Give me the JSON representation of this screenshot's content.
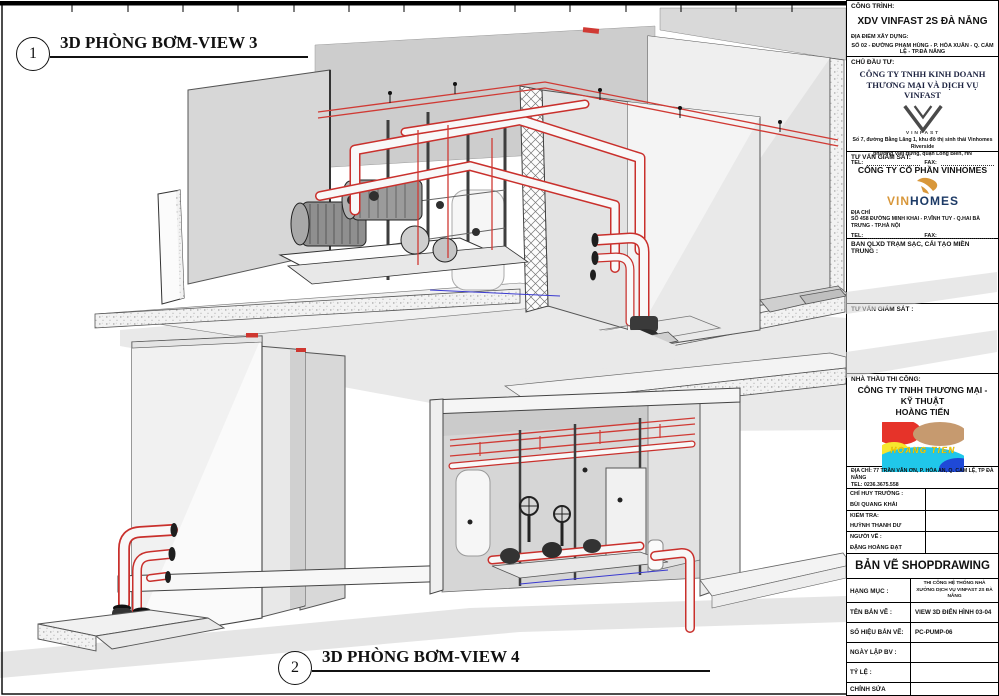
{
  "sheet": {
    "view3": {
      "number": "1",
      "title": "3D PHÒNG BƠM-VIEW 3"
    },
    "view4": {
      "number": "2",
      "title": "3D PHÒNG BƠM-VIEW 4"
    }
  },
  "title_block": {
    "project": {
      "label": "CÔNG TRÌNH:",
      "name": "XDV VINFAST 2S ĐÀ NẴNG",
      "site_label": "ĐỊA ĐIỂM XÂY DỰNG:",
      "site": "SỐ 02 - ĐƯỜNG PHẠM HÙNG - P. HÒA XUÂN - Q. CẨM LỆ - TP.ĐÀ NẴNG"
    },
    "investor": {
      "label": "CHỦ ĐẦU TƯ:",
      "company_line1": "CÔNG TY TNHH KINH DOANH",
      "company_line2": "THƯƠNG MẠI VÀ DỊCH VỤ  VINFAST",
      "logo_text": "VINFAST",
      "address_line1": "Số 7, đường Bằng Lăng 1, khu đô thị sinh thái Vinhomes Riverside",
      "address_line2": "phường Việt Hưng, quận Long Biên, HN",
      "tel_label": "TEL:",
      "fax_label": "FAX:"
    },
    "supervisor": {
      "label": "TƯ VẤN GIÁM SÁT:",
      "company": "CÔNG TY CỔ PHẦN VINHOMES",
      "logo_vin": "VIN",
      "logo_homes": "HOMES",
      "address_label": "ĐỊA CHỈ",
      "address": "SỐ 458 ĐƯỜNG MINH KHAI - P.VĨNH TUY - Q.HAI BÀ TRƯNG - TP.HÀ NỘI",
      "tel_label": "TEL:",
      "fax_label": "FAX:"
    },
    "management_board": {
      "label": "BAN QLXD TRẠM SẠC, CẢI TẠO MIỀN TRUNG :"
    },
    "supervisor2": {
      "label": "TƯ VẤN GIÁM SÁT :"
    },
    "contractor": {
      "label": "NHÀ THẦU THI CÔNG:",
      "company_line1": "CÔNG TY TNHH THƯƠNG MẠI - KỸ THUẬT",
      "company_line2": "HOÀNG TIẾN",
      "logo_text": "HOANG TIEN",
      "address_label": "ĐỊA CHỈ:",
      "address": "77 TRẦN VĂN ƠN, P. HÒA AN, Q. CẨM LỆ, TP ĐÀ NẴNG",
      "tel": "TEL: 0236.3675.558"
    },
    "signers": [
      {
        "role": "CHỈ HUY TRƯỞNG :",
        "name": "BÙI QUANG KHẢI"
      },
      {
        "role": "KIỂM TRA:",
        "name": "HUỲNH THANH DƯ"
      },
      {
        "role": "NGƯỜI VẼ :",
        "name": "ĐẶNG HOÀNG ĐẠT"
      }
    ],
    "drawing_type": "BẢN VẼ SHOPDRAWING",
    "rows": [
      {
        "label": "HẠNG MỤC :",
        "value": "THI CÔNG HỆ THỐNG NHÀ XƯỞNG DỊCH VỤ VINFAST 2S ĐÀ NẴNG"
      },
      {
        "label": "TÊN BẢN VẼ :",
        "value": "VIEW 3D ĐIỂN HÌNH 03-04"
      },
      {
        "label": "SỐ HIỆU BẢN VẼ:",
        "value": "PC-PUMP-06"
      },
      {
        "label": "NGÀY LẬP BV :",
        "value": ""
      },
      {
        "label": "TỶ LỆ :",
        "value": ""
      },
      {
        "label": "CHỈNH SỬA",
        "value": ""
      }
    ]
  },
  "colors": {
    "pipe_red": "#c9302c",
    "line_red": "#d03a34",
    "drain_blue": "#3a3ad0",
    "vinhomes_gold": "#d8973a",
    "vinhomes_navy": "#1c3a66",
    "hoangtien_red": "#e63329",
    "hoangtien_tan": "#c69a6f",
    "hoangtien_cyan": "#20c7ea",
    "hoangtien_blue": "#1f49d7",
    "hoangtien_yellow": "#ffe100"
  }
}
